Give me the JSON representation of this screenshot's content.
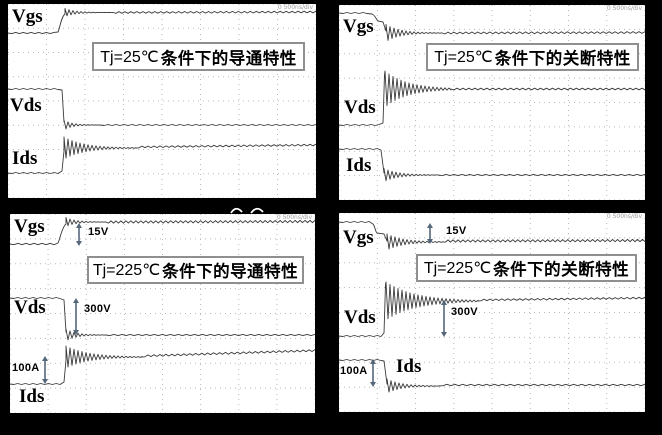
{
  "colors": {
    "background": "#000000",
    "panel_bg": "#ffffff",
    "trace": "#3a3a3a",
    "grid_dots": "#b8b8b8",
    "title_border": "#8f8f8f",
    "arrow": "#55677a",
    "scale_note_text": "#9a9a9a"
  },
  "panels": [
    {
      "id": "turn-on-25c",
      "title_prefix": "Tj=25℃",
      "title_suffix": "条件下的导通特性",
      "labels": {
        "vgs": "Vgs",
        "vds": "Vds",
        "ids": "Ids"
      },
      "scale_note": "0 500ns/div"
    },
    {
      "id": "turn-off-25c",
      "title_prefix": "Tj=25℃",
      "title_suffix": "条件下的关断特性",
      "labels": {
        "vgs": "Vgs",
        "vds": "Vds",
        "ids": "Ids"
      },
      "scale_note": "0 500ns/div"
    },
    {
      "id": "turn-on-225c",
      "title_prefix": "Tj=225℃",
      "title_suffix": "条件下的导通特性",
      "labels": {
        "vgs": "Vgs",
        "vds": "Vds",
        "ids": "Ids"
      },
      "scale_note": "0 500ns/div",
      "ann": {
        "vgs": "15V",
        "vds": "300V",
        "ids": "100A"
      }
    },
    {
      "id": "turn-off-225c",
      "title_prefix": "Tj=225℃",
      "title_suffix": "条件下的关断特性",
      "labels": {
        "vgs": "Vgs",
        "vds": "Vds",
        "ids": "Ids"
      },
      "scale_note": "0 500ns/div",
      "ann": {
        "vgs": "15V",
        "vds": "300V",
        "ids": "100A"
      }
    }
  ],
  "chart_data": [
    {
      "type": "line",
      "title": "Tj=25℃条件下的导通特性",
      "xlabel": "time (oscilloscope screen, ~8 divisions, timebase note illegible)",
      "ylabel": "",
      "grid": true,
      "legend_position": "trace names printed on plot",
      "series": [
        {
          "name": "Vgs",
          "shape": "flat low, steps up at ~1.5 div to flat high gate level",
          "ringing": "brief overshoot ringing after turn-on"
        },
        {
          "name": "Vds",
          "shape": "flat high bus level, steps down at ~1.6 div to near zero",
          "ringing": "small undershoot ringing"
        },
        {
          "name": "Ids",
          "shape": "flat at zero, steps up at ~1.6 div to load-current level",
          "ringing": "large slowly-decaying ringing burst"
        }
      ]
    },
    {
      "type": "line",
      "title": "Tj=25℃条件下的关断特性",
      "xlabel": "time (oscilloscope screen, ~8 divisions, timebase note illegible)",
      "ylabel": "",
      "grid": true,
      "legend_position": "trace names printed on plot",
      "series": [
        {
          "name": "Vgs",
          "shape": "flat high, Miller plateau then steps down at ~1.2 div to flat low",
          "ringing": "decaying ringing after fall"
        },
        {
          "name": "Vds",
          "shape": "flat near zero, steps up at ~1.3 div to bus level",
          "ringing": "large overshoot ringing burst at turn-off"
        },
        {
          "name": "Ids",
          "shape": "flat high load current, steps down at ~1.3 div to zero",
          "ringing": "decaying ringing after fall"
        }
      ]
    },
    {
      "type": "line",
      "title": "Tj=225℃条件下的导通特性",
      "xlabel": "time (oscilloscope screen, ~8 divisions, timebase note illegible)",
      "ylabel": "",
      "grid": true,
      "legend_position": "trace names printed on plot",
      "annotated_values": {
        "Vgs_swing": "15V",
        "Vds_swing": "300V",
        "Ids_swing": "100A"
      },
      "series": [
        {
          "name": "Vgs",
          "shape": "flat low, steps up at ~1.5 div by 15 V to flat high",
          "ringing": "brief overshoot ringing"
        },
        {
          "name": "Vds",
          "shape": "flat high, steps down at ~1.6 div by 300 V to near zero",
          "ringing": "small undershoot ringing"
        },
        {
          "name": "Ids",
          "shape": "flat at zero, steps up at ~1.6 div by 100 A",
          "ringing": "large slowly-decaying ringing burst"
        }
      ]
    },
    {
      "type": "line",
      "title": "Tj=225℃条件下的关断特性",
      "xlabel": "time (oscilloscope screen, ~8 divisions, timebase note illegible)",
      "ylabel": "",
      "grid": true,
      "legend_position": "trace names printed on plot",
      "annotated_values": {
        "Vgs_swing": "15V",
        "Vds_swing": "300V",
        "Ids_swing": "100A"
      },
      "series": [
        {
          "name": "Vgs",
          "shape": "flat high, plateau then steps down at ~1.3 div by 15 V",
          "ringing": "decaying ringing after fall"
        },
        {
          "name": "Vds",
          "shape": "flat near zero, steps up at ~1.4 div by 300 V",
          "ringing": "very large overshoot ringing burst"
        },
        {
          "name": "Ids",
          "shape": "flat high, steps down at ~1.4 div by 100 A to zero",
          "ringing": "decaying ringing after fall"
        }
      ]
    }
  ]
}
